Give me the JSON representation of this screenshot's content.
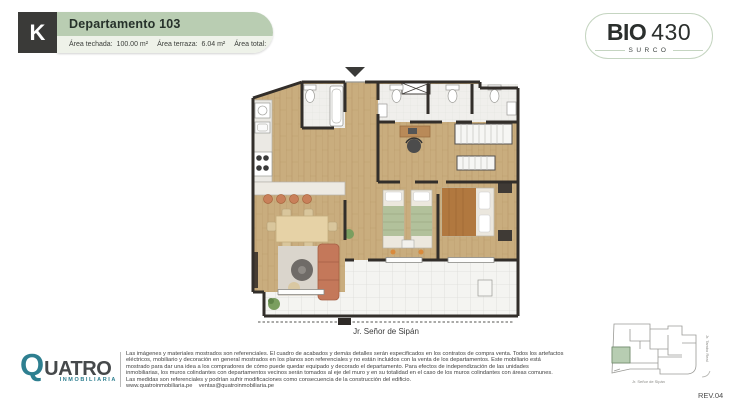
{
  "header": {
    "unit_letter": "K",
    "title": "Departamento 103",
    "areas": [
      {
        "label": "Área techada:",
        "value": "100.00 m²"
      },
      {
        "label": "Área terraza:",
        "value": "6.04 m²"
      },
      {
        "label": "Área total:",
        "value": "106.04 m²"
      }
    ]
  },
  "brand": {
    "bold": "BIO",
    "light": "430",
    "district": "SURCO"
  },
  "plan": {
    "street": "Jr. Señor de Sipán"
  },
  "logo": {
    "q": "Q",
    "rest": "UATRO",
    "sub": "INMOBILIARIA"
  },
  "legal": {
    "lines": [
      "Las imágenes y materiales mostrados son referenciales. El cuadro de acabados y demás detalles serán especificados en los contratos de compra venta. Todos los artefactos",
      "eléctricos, mobiliario y decoración en general mostrados en los planos son referenciales y no están incluidos con la venta de los departamentos. Este mobiliario está",
      "mostrado para dar una idea a los compradores de cómo puede quedar equipado y decorado el departamento. Para efectos de independización de las unidades",
      "inmobiliarias, los muros colindantes con departamentos vecinos serán tomados al eje del muro y en su totalidad en el caso de los muros colindantes con áreas comunes.",
      "Las medidas son referenciales y podrían sufrir modificaciones como consecuencia de la construcción del edificio.",
      "www.quatroinmobiliaria.pe    ventas@quatroinmobiliaria.pe"
    ]
  },
  "keyplan": {
    "street_right": "Jr. Tambo Real",
    "street_bottom": "Jr. Señor de Sipán"
  },
  "revision": "REV.04",
  "colors": {
    "sage": "#b9cdb2",
    "teal": "#2e7f90",
    "wall": "#322e2a",
    "wood": "#c9ad7e"
  }
}
